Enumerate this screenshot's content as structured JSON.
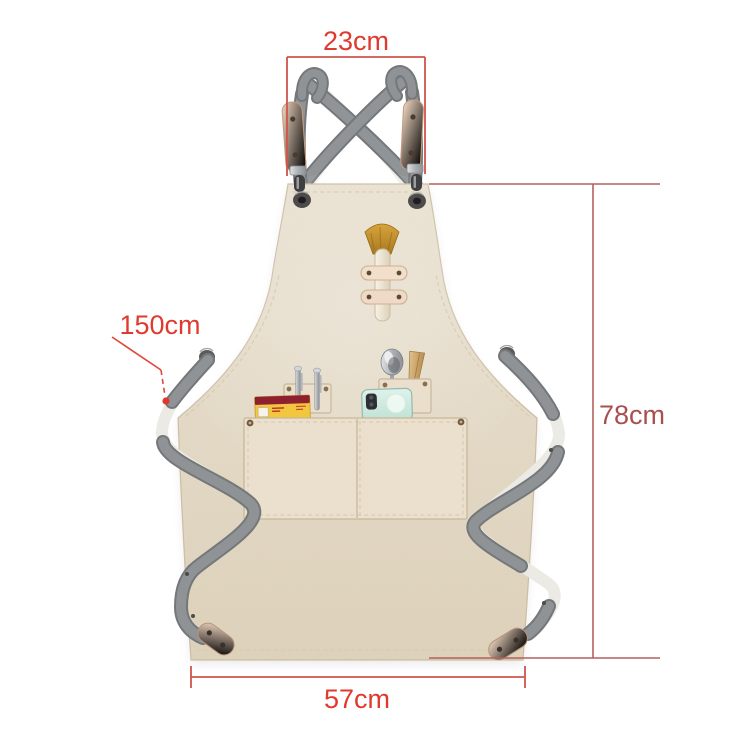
{
  "annotations": {
    "top_width": {
      "label": "23cm"
    },
    "strap_length": {
      "label": "150cm"
    },
    "height": {
      "label": "78cm"
    },
    "bottom_width": {
      "label": "57cm"
    }
  },
  "colors": {
    "dimension_red": "#e03a2e",
    "dimension_brick": "#a8504e",
    "bracket_line_red": "#d0544c",
    "height_line": "#b4605e",
    "fabric_beige": "#e8decb",
    "strap_gray": "#909496",
    "leather_tan": "#eccab2",
    "brush_bristle": "#c08a2c",
    "phone_mint": "#cfe9df",
    "box_yellow": "#f2c63e",
    "box_band_red": "#8e2030"
  },
  "scene": {
    "product": "canvas cross-back apron",
    "items_visible": [
      "crossed shoulder straps",
      "snap hooks",
      "side grommets",
      "brush in leather loops",
      "pen pocket with two pens",
      "yellow box",
      "spoon",
      "wooden handle tool",
      "mint phone",
      "divided front pocket",
      "leather strap tips"
    ]
  }
}
